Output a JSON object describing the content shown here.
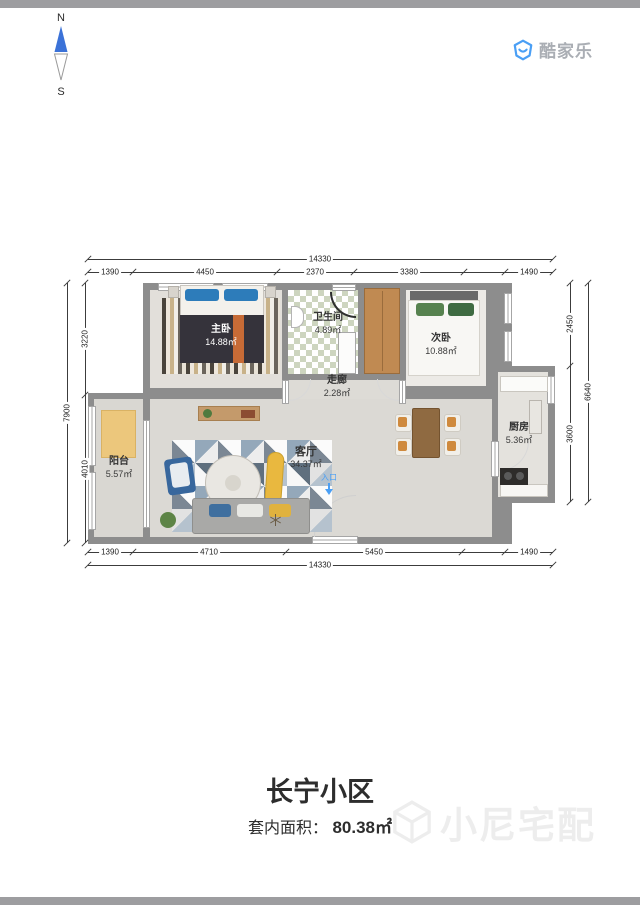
{
  "compass": {
    "north": "N",
    "south": "S"
  },
  "logo": {
    "brand": "酷家乐"
  },
  "plan": {
    "rooms": {
      "master": {
        "name": "主卧",
        "area": "14.88㎡"
      },
      "bath": {
        "name": "卫生间",
        "area": "4.89㎡"
      },
      "bed2": {
        "name": "次卧",
        "area": "10.88㎡"
      },
      "corridor": {
        "name": "走廊",
        "area": "2.28㎡"
      },
      "living": {
        "name": "客厅",
        "area": "34.37㎡"
      },
      "balcony": {
        "name": "阳台",
        "area": "5.57㎡"
      },
      "kitchen": {
        "name": "厨房",
        "area": "5.36㎡"
      }
    },
    "entrance": {
      "label": "入口"
    },
    "dims": {
      "top": {
        "total": "14330",
        "segments": [
          "1390",
          "4450",
          "2370",
          "3380",
          "1490"
        ]
      },
      "bottom": {
        "total": "14330",
        "segments": [
          "1390",
          "4710",
          "5450",
          "1490"
        ]
      },
      "left": {
        "total": "7900",
        "segments": [
          "3220",
          "4010"
        ]
      },
      "right": {
        "total": "6640",
        "segments": [
          "2450",
          "3600"
        ]
      }
    }
  },
  "footer": {
    "title": "长宁小区",
    "area_label": "套内面积：",
    "area_value": "80.38㎡",
    "watermark": "小尼宅配"
  },
  "colors": {
    "brand_blue": "#4a9ff5",
    "compass_blue": "#3b72d8",
    "entrance_blue": "#4a9ff5",
    "wall_gray": "#8d8d8d",
    "accent_orange": "#c76b36"
  }
}
